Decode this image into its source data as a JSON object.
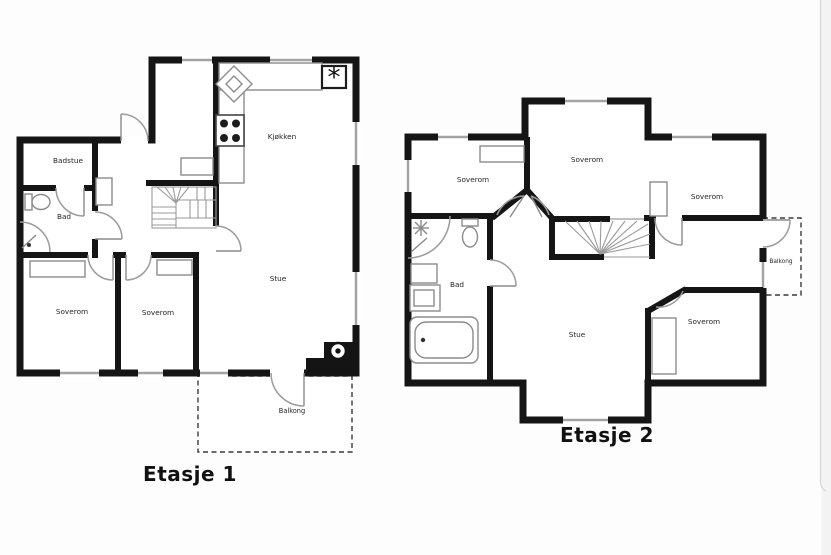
{
  "page": {
    "background": "#fdfdfd",
    "wall_color": "#151515",
    "window_color": "#a3a3a3",
    "door_color": "#9b9b9b",
    "furniture_color": "#8c8c8c",
    "label_color": "#262626",
    "edge_line_color": "#d8d8d8"
  },
  "floor1": {
    "caption": "Etasje 1",
    "rooms": {
      "badstue": "Badstue",
      "bad": "Bad",
      "soverom_left": "Soverom",
      "soverom_mid": "Soverom",
      "stue": "Stue",
      "kjokken": "Kjøkken",
      "balkong": "Balkong"
    },
    "symbols": {
      "chimney": "*"
    }
  },
  "floor2": {
    "caption": "Etasje 2",
    "rooms": {
      "soverom_left": "Soverom",
      "soverom_top": "Soverom",
      "soverom_right": "Soverom",
      "soverom_bottom": "Soverom",
      "bad": "Bad",
      "stue": "Stue",
      "balkong": "Balkong"
    }
  }
}
